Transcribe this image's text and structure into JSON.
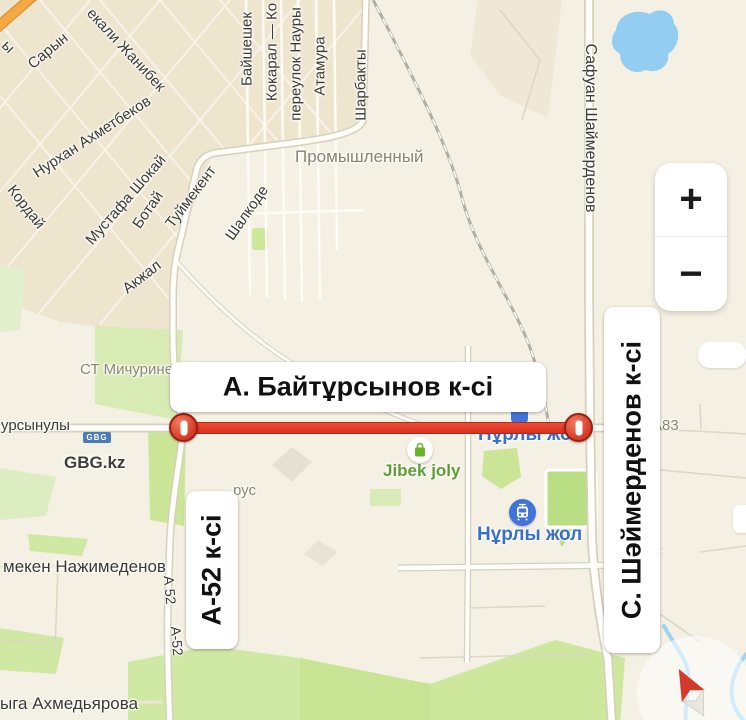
{
  "overlay_labels": {
    "closed_street": "А. Байтұрсынов к-сі",
    "left_cross_street": "А-52 к-сі",
    "right_cross_street": "С. Шәймерденов к-сі"
  },
  "streets": {
    "partial_y": "ы",
    "saryn": "Сарын",
    "zhanibek_partial": "екали Жанибек",
    "akhmetbekov": "Нурхан Ахметбеков",
    "korday": "Кордай",
    "mustafa_shokay": "Мустафа Шокай",
    "botay": "Ботай",
    "tuymekent": "Туймекент",
    "shalkode": "Шалкоде",
    "akzhal": "Акжал",
    "baisheshek": "Байшешек",
    "kokaral_partial": "Кокарал — Ко",
    "pereulok_naury": "переулок Науры",
    "atamura": "Атамура",
    "sharbakty": "Шарбакты",
    "safuan_shaimerdenov": "Сафуан Шаймерденов",
    "ursynuly_partial": "урсынулы",
    "nazhimedenov_partial": "мекен Нажимеденов",
    "akhmedyarova_partial": "ыга Ахмедьярова",
    "a52_marker_1": "А 52",
    "a52_marker_2": "А-52",
    "a83": "А83"
  },
  "places": {
    "promyshlenny": "Промышленный",
    "michurinets": "СТ Мичуринец",
    "rus_partial": "рус",
    "gbg_site": "GBG.kz",
    "gbg_logo": "GBG",
    "jibek_joly": "Jibek joly",
    "nurly_zhol_upper": "Нұрлы жол",
    "nurly_zhol_station": "Нұрлы жол"
  },
  "controls": {
    "zoom_in": "+",
    "zoom_out": "−"
  },
  "colors": {
    "background": "#f4f0e3",
    "residential": "#eee5cf",
    "closure_red": "#e23b28",
    "marker_red": "#d63a26",
    "water_blue": "#93cef2",
    "green_area": "#cfe8a3",
    "poi_green": "#5d9e33",
    "poi_blue": "#3a6ecb",
    "road_white": "#fffefa",
    "road_casing": "#d6d0bc",
    "orange_road": "#f4a944"
  }
}
